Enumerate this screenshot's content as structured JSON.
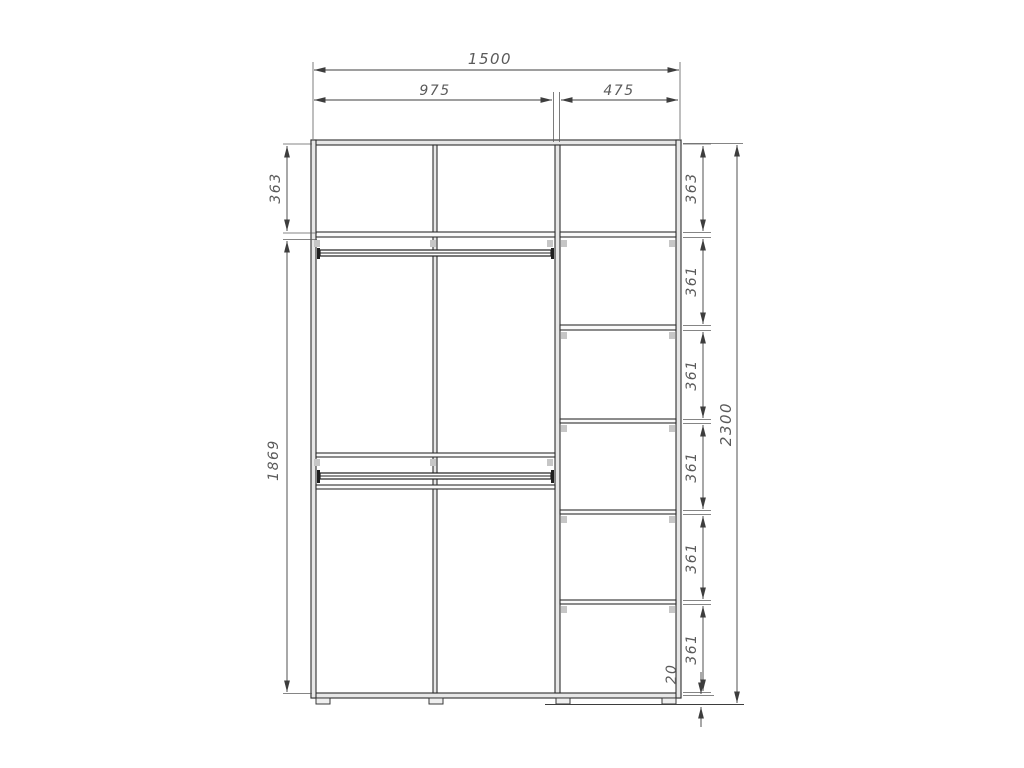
{
  "drawing": {
    "kind": "wardrobe-interior-dimension-drawing"
  },
  "dims": {
    "total_width": "1500",
    "left_section_width": "975",
    "right_section_width": "475",
    "total_height": "2300",
    "left_top_cell": "363",
    "left_lower_height": "1869",
    "right_cells": [
      "363",
      "361",
      "361",
      "361",
      "361",
      "361"
    ],
    "plinth_height": "20"
  },
  "colors": {
    "object_line": "#2e2e2e",
    "dimension_line": "#3d3d3d",
    "dimension_text": "#5a5a5a",
    "panel_fill": "#e7e7e7",
    "hardware_clip": "#c6c6c6",
    "background": "#ffffff"
  }
}
